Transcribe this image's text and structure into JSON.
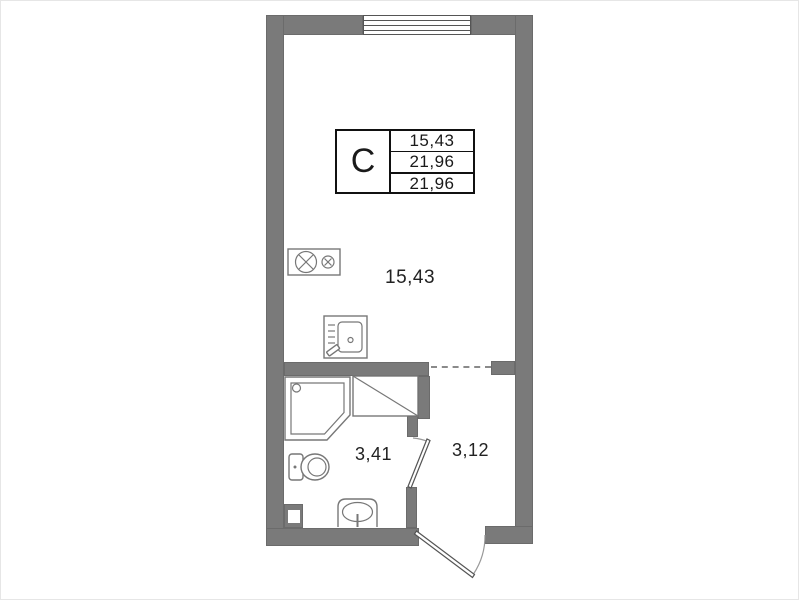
{
  "stamp": {
    "type_label": "С",
    "rows": [
      "15,43",
      "21,96",
      "21,96"
    ]
  },
  "rooms": {
    "main": {
      "area": "15,43"
    },
    "bathroom": {
      "area": "3,41"
    },
    "hallway": {
      "area": "3,12"
    }
  },
  "fixtures": [
    "window",
    "kitchen-sink",
    "appliance",
    "shower-cabin",
    "closet",
    "toilet",
    "washbasin",
    "bathroom-door",
    "entrance-door"
  ],
  "colors": {
    "wall": "#7a7a7a",
    "line": "#555555",
    "fixture_stroke": "#777777",
    "text": "#1a1a1a"
  }
}
